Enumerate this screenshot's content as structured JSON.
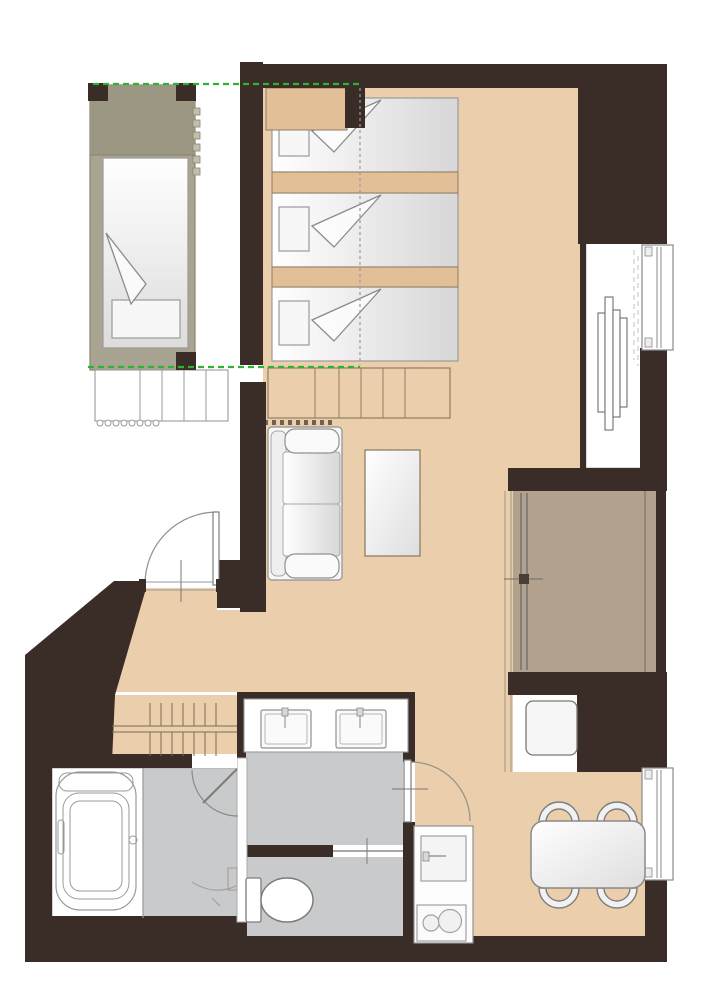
{
  "meta": {
    "type": "apartment-floor-plan",
    "floors_shown": 1,
    "bed_count": 4,
    "dining_chair_count": 4,
    "sink_count": 3,
    "stove_burner_count": 2
  },
  "colors": {
    "wall": "#3a2d27",
    "floor_tan": "#ebcfac",
    "floor_tan_dark": "#e3bf97",
    "strip_border": "#8f7d66",
    "floor_gray": "#c9cacb",
    "floor_olive": "#a9a391",
    "floor_olive_dark": "#9c9783",
    "floor_balcony": "#b2a28d",
    "white": "#ffffff",
    "furniture_fill": "#fbfbfb",
    "furniture_stroke": "#8f8f8f",
    "dark_stroke": "#7d7d7d",
    "loft_dash_green": "#2eb135",
    "loft_dash_gray": "#9a9a9a",
    "line_brown": "#7a6a58"
  }
}
